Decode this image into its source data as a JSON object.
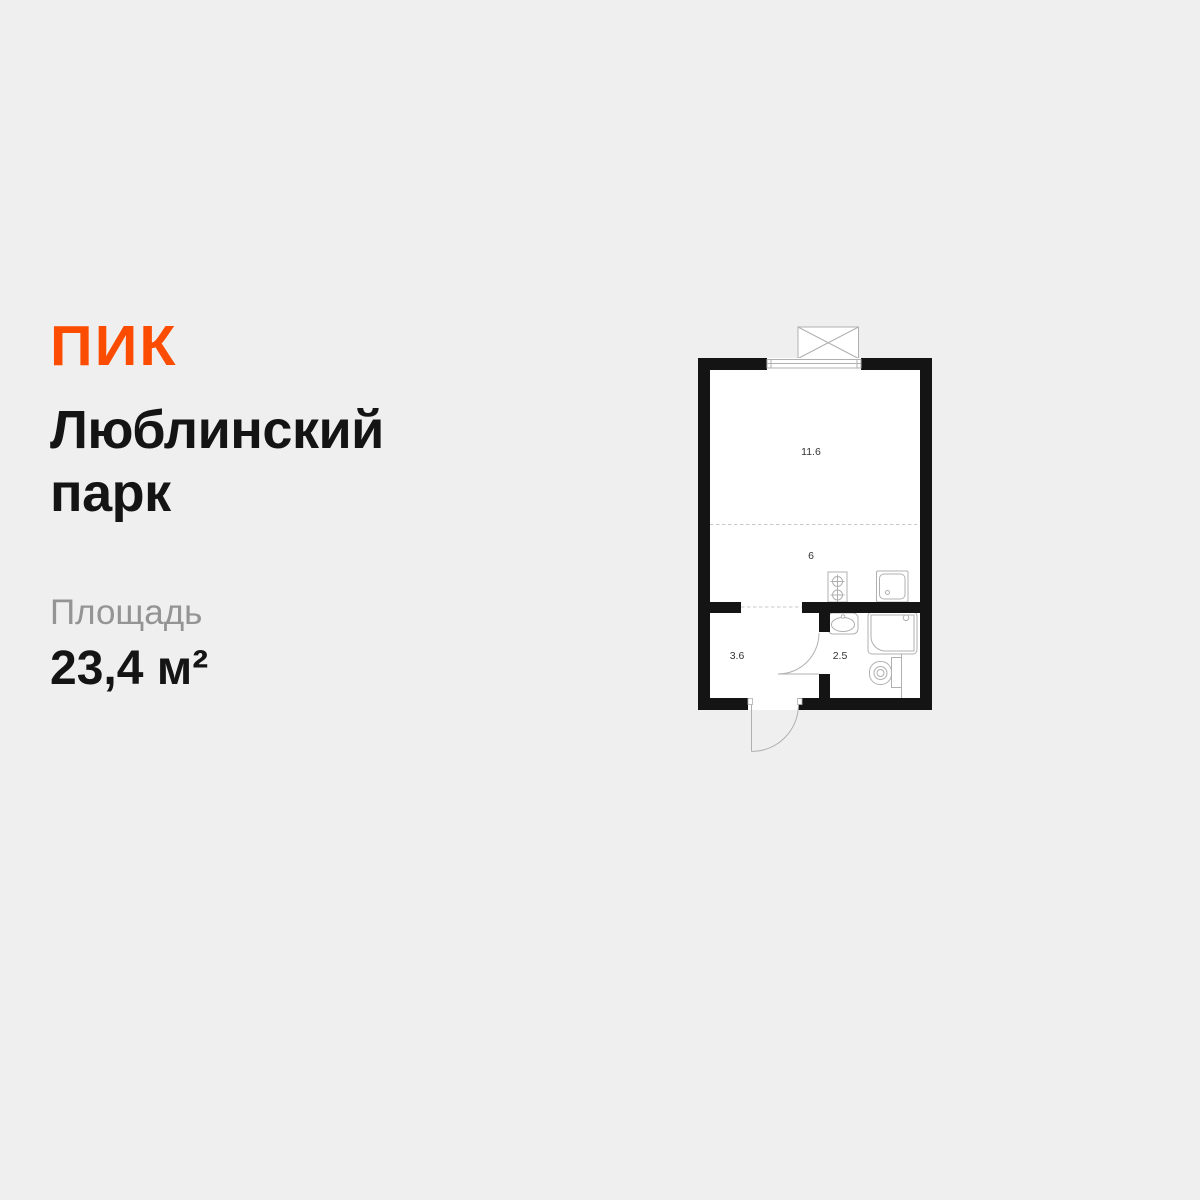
{
  "brand": {
    "logo": "ПИК"
  },
  "listing": {
    "title": "Люблинский парк",
    "area_label": "Площадь",
    "area_value": "23,4 м²"
  },
  "plan": {
    "rooms": [
      {
        "name": "living-room",
        "area_label": "11.6"
      },
      {
        "name": "kitchen",
        "area_label": "6"
      },
      {
        "name": "hallway",
        "area_label": "3.6"
      },
      {
        "name": "bathroom",
        "area_label": "2.5"
      }
    ]
  },
  "theme": {
    "bg": "#efefef",
    "text": "#141414",
    "muted": "#949494",
    "accent": "#fc4c02",
    "wall": "#141414",
    "outline": "#b0b0b0",
    "dash": "#c9c9c9",
    "floor": "#ffffff"
  }
}
